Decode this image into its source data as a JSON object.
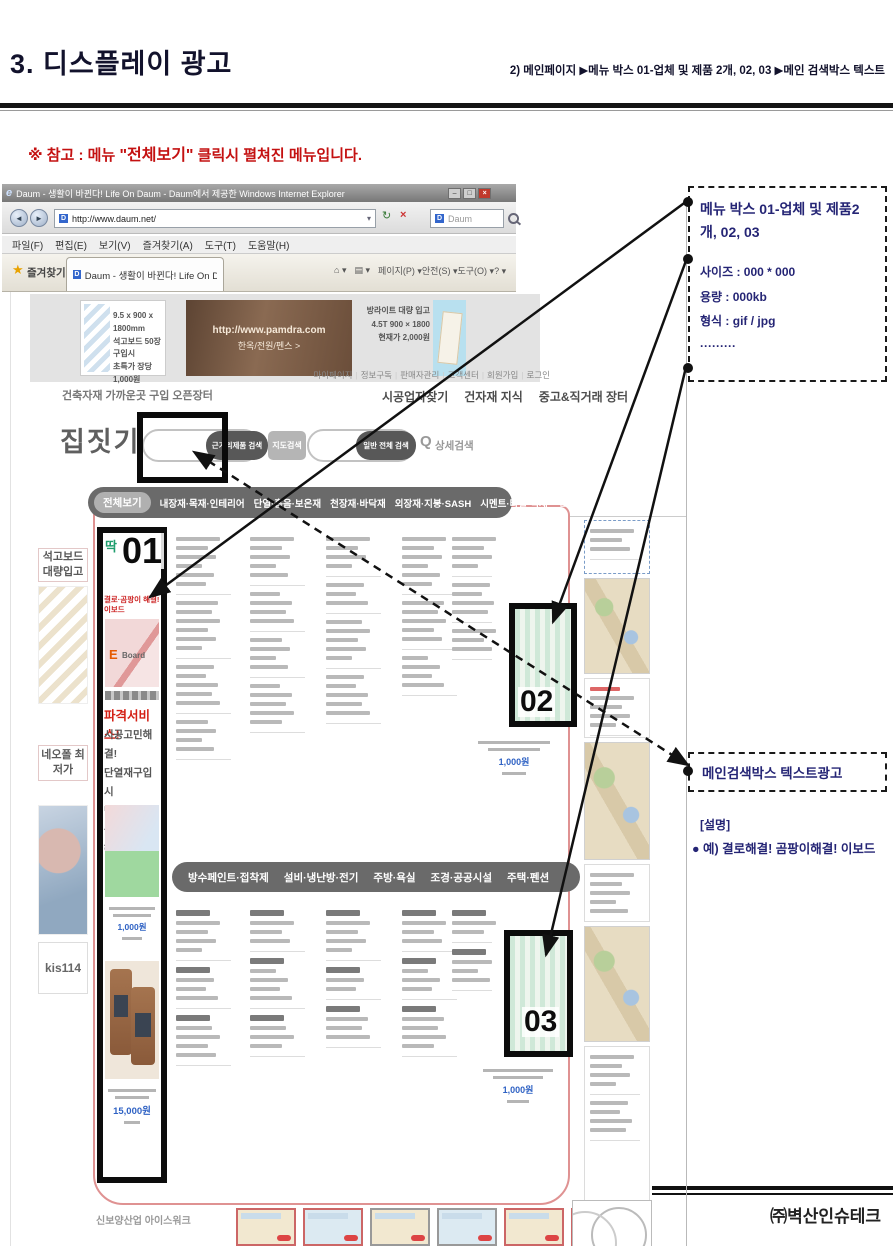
{
  "doc": {
    "title": "3. 디스플레이 광고",
    "header_right": "2)  메인페이지  ▶메뉴 박스 01-업체 및 제품 2개, 02, 03 ▶메인 검색박스 텍스트",
    "note_prefix": "※ 참고 : 메뉴 ",
    "note_highlight": "\"전체보기\"",
    "note_suffix": " 클릭시 펼쳐진 메뉴입니다.",
    "company": "㈜벽산인슈테크"
  },
  "icons": {
    "ie": "e",
    "daum": "D",
    "star": "★",
    "home": "⌂",
    "feed": "▤",
    "back": "◄",
    "forward": "►",
    "refresh": "↻",
    "stop": "×",
    "dropdown": "▾",
    "minimize": "–",
    "maximize": "□",
    "close": "×",
    "q": "Q",
    "bullet": "●"
  },
  "browser": {
    "window_title": "Daum - 생활이 바뀐다! Life On Daum - Daum에서 제공한 Windows Internet Explorer",
    "url": "http://www.daum.net/",
    "search_engine": "Daum",
    "menu_items": [
      "파일(F)",
      "편집(E)",
      "보기(V)",
      "즐겨찾기(A)",
      "도구(T)",
      "도움말(H)"
    ],
    "favorites_label": "즐겨찾기",
    "tab_title": "Daum - 생활이 바뀐다! Life On Daum",
    "command_items": [
      "페이지(P) ▾",
      "안전(S) ▾",
      "도구(O) ▾",
      "? ▾"
    ]
  },
  "site": {
    "banner1": {
      "l1": "9.5 x 900 x 1800mm",
      "l2": "석고보드 50장 구입시",
      "l3": "초특가 장당 1,000원"
    },
    "banner2": {
      "url": "http://www.pamdra.com",
      "label": "한옥/전원/펜스 >"
    },
    "banner3": {
      "l1": "방라이트 대량 입고",
      "l2": "4.5T 900 × 1800",
      "l3": "현재가 2,000원"
    },
    "utility_links": [
      "마이페이지",
      "정보구독",
      "판매자관리",
      "고객센터",
      "회원가입",
      "로그인"
    ],
    "nav_left": "건축자재 가까운곳 구입 오픈장터",
    "nav_right": [
      "시공업자찾기",
      "건자재 지식",
      "중고&직거래 장터"
    ],
    "logo": "집짓기",
    "btn_near": "근거리제품 검색",
    "btn_map": "지도검색",
    "btn_all": "일반 전체 검색",
    "detail_search": "상세검색",
    "catbar1": [
      "전체보기",
      "내장재·목재·인테리어",
      "단열·흡음·보온재",
      "천장재·바닥재",
      "외장재·지붕·SASH",
      "시멘트·타일·석재",
      "전국 판매자 찾기"
    ],
    "catbar2": [
      "방수페인트·접착제",
      "설비·냉난방·전기",
      "주방·욕실",
      "조경·공공시설",
      "주택·펜션"
    ],
    "sidebar_ads": [
      {
        "label": "석고보드 대량입고"
      },
      {
        "label": "네오폴 최저가"
      },
      {
        "label": "kis114"
      }
    ],
    "box01": {
      "sticker": "딱",
      "redline": "결로·곰팡이 해결! 이보드",
      "eboard_e": "E",
      "eboard_board": "Board",
      "service": "파격서비스!",
      "pitch": [
        "시공고민해결!",
        "단열재구입시",
        "단열무료시공을",
        "해드립니다."
      ],
      "price1": "1,000원",
      "price2": "15,000원"
    },
    "box02": {
      "price": "1,000원"
    },
    "box03": {
      "price": "1,000원"
    },
    "menu_columns": {
      "upper0": [
        6,
        6,
        5,
        4
      ],
      "upper1": [
        5,
        4,
        4,
        5
      ],
      "upper2": [
        4,
        3,
        5,
        5
      ],
      "upper3": [
        6,
        5,
        4
      ],
      "upper4": [
        4,
        4,
        3
      ],
      "lower0": [
        5,
        4,
        5
      ],
      "lower1": [
        4,
        5,
        4
      ],
      "lower2": [
        5,
        3,
        4
      ],
      "lower3": [
        4,
        4,
        5
      ],
      "lower4": [
        3,
        4
      ],
      "right_a": [
        3
      ],
      "right_b": [
        4,
        3
      ],
      "right_c": [
        5
      ],
      "right_d": [
        4,
        4
      ]
    },
    "bottom_left": "신보양산업 아이스워크",
    "thumb_count": 6
  },
  "annotations": {
    "label01": "01",
    "label02": "02",
    "label03": "03",
    "boxA_title": "메뉴 박스 01-업체 및 제품2개, 02, 03",
    "boxA_specs": [
      "사이즈 : 000 * 000",
      "용량 : 000kb",
      "형식 : gif / jpg",
      "·········"
    ],
    "boxB_title": "메인검색박스 텍스트광고",
    "desc_title": "[설명]",
    "desc_line": "● 예) 결로해결! 곰팡이해결! 이보드"
  }
}
